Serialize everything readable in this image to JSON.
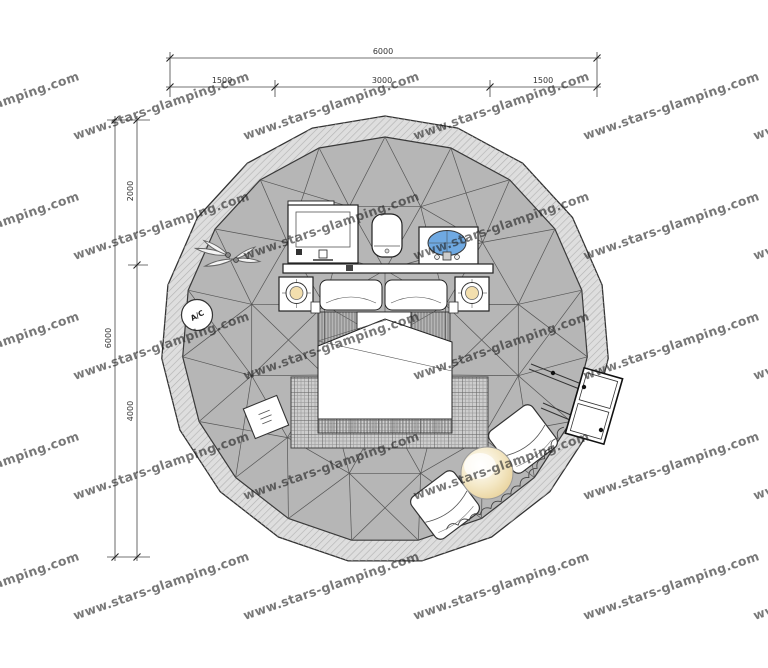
{
  "title": "glamping-dome-floor-plan",
  "watermark": {
    "text": "www.stars-glamping.com"
  },
  "dimensions": {
    "top": {
      "total": "6000",
      "segments": [
        "1500",
        "3000",
        "1500"
      ]
    },
    "left": {
      "total": "6000",
      "segments": [
        "2000",
        "4000"
      ]
    }
  },
  "labels": {
    "ac": "A/C"
  },
  "colors": {
    "background": "#ffffff",
    "dome_fill": "#b6b6b6",
    "band_fill": "#dedede",
    "band_hatch": "#b3b3b3",
    "mesh_line": "#555555",
    "outline": "#222222",
    "dim_line": "#444444",
    "dim_text": "#333333",
    "watermark": "#1f1f1f",
    "lamp": "#f3dfae",
    "sink_blue": "#6fa9e2",
    "table_cream": "#e7cf96"
  }
}
